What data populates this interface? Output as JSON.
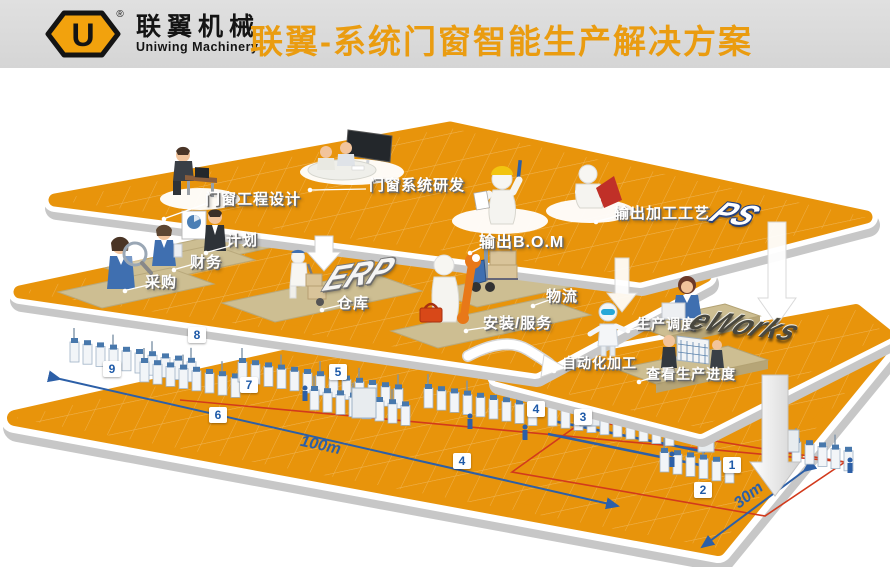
{
  "header": {
    "logo_letter": "U",
    "registered_mark": "®",
    "brand_cn": "联翼机械",
    "brand_en": "Uniwing Machinery",
    "title": "联翼-系统门窗智能生产解决方案"
  },
  "ps_tier": {
    "logo": "PS",
    "label_design": "门窗工程设计",
    "label_rd": "门窗系统研发",
    "label_bom": "输出B.O.M",
    "label_process": "输出加工工艺"
  },
  "erp_tier": {
    "logo": "ERP",
    "label_plan": "计划",
    "label_finance": "财务",
    "label_purchase": "采购",
    "label_warehouse": "仓库",
    "label_logistics": "物流",
    "label_install": "安装/服务"
  },
  "eworks_tier": {
    "logo": "eWorks",
    "label_dispatch": "生产调度",
    "label_auto": "自动化加工",
    "label_view_progress": "查看生产进度"
  },
  "factory": {
    "stations": [
      "1",
      "2",
      "3",
      "4",
      "4",
      "5",
      "6",
      "7",
      "8",
      "9"
    ],
    "dim_length": "100m",
    "dim_width": "30m"
  },
  "colors": {
    "floor_orange": "#E8940B",
    "title_orange": "#EA9C10",
    "station_blue": "#1E5AA8",
    "dimension_blue": "#2C5FA7",
    "route_red": "#D23A1C",
    "mat_khaki": "#CDBE92",
    "header_gray": "#D8D8D8"
  }
}
